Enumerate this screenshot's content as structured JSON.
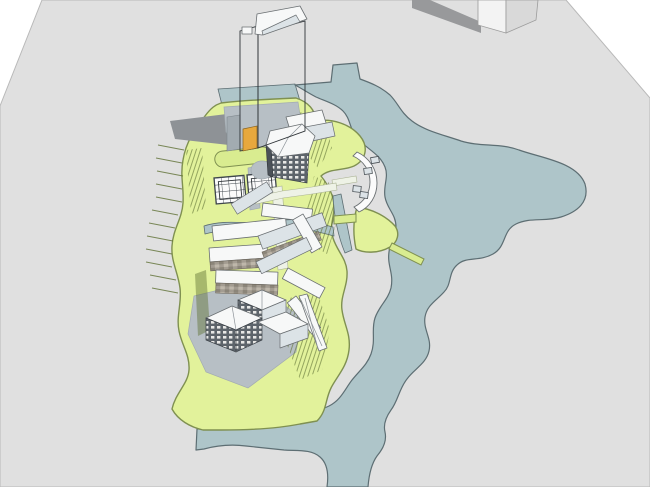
{
  "meta": {
    "description": "Aerial 3D architectural massing model of a waterfront masterplan: a high-rise tower, mid-rise podium, low-rise clusters with pitched roofs on a green landscaped island surrounded by an organic lake and canals",
    "width": 650,
    "height": 487
  },
  "palette": {
    "background": "#ffffff",
    "ground": "#e0e0e0",
    "ground_line": "#b9b9b9",
    "shadow": "#98999b",
    "tower_shadow": "#8e9296",
    "water": "#aec5c9",
    "water_edge": "#5d6e73",
    "lawn": "#e2f29b",
    "lawn_light": "#d9ec90",
    "lawn_edge": "#7f9051",
    "plaza": "#b7bfc5",
    "plaza_dark": "#a2abb1",
    "roof": "#f7f8f8",
    "roof_shade": "#dce3e7",
    "facade_dark": "#4b5158",
    "facade_stripe": "#c7ced3",
    "mullion": "#868e95",
    "window_bg": "#5d646b",
    "window_lite": "#e8e8e6",
    "brick_a": "#a39c91",
    "brick_b": "#8b8579",
    "brick_c": "#beb7aa",
    "accent": "#e7a83d",
    "tree": "#5f7034",
    "pier": "#fbfbfb",
    "outline": "#6a6f72"
  },
  "scene": {
    "objects": [
      "ground-plane",
      "background-monolith",
      "lake",
      "waterfront-strip",
      "site-green-platform",
      "tower",
      "podium-building",
      "glass-pavilions",
      "mixed-use-cluster",
      "gabled-houses",
      "curved-pier",
      "lawn-wedge",
      "footbridges",
      "canals",
      "tree-clusters"
    ]
  }
}
